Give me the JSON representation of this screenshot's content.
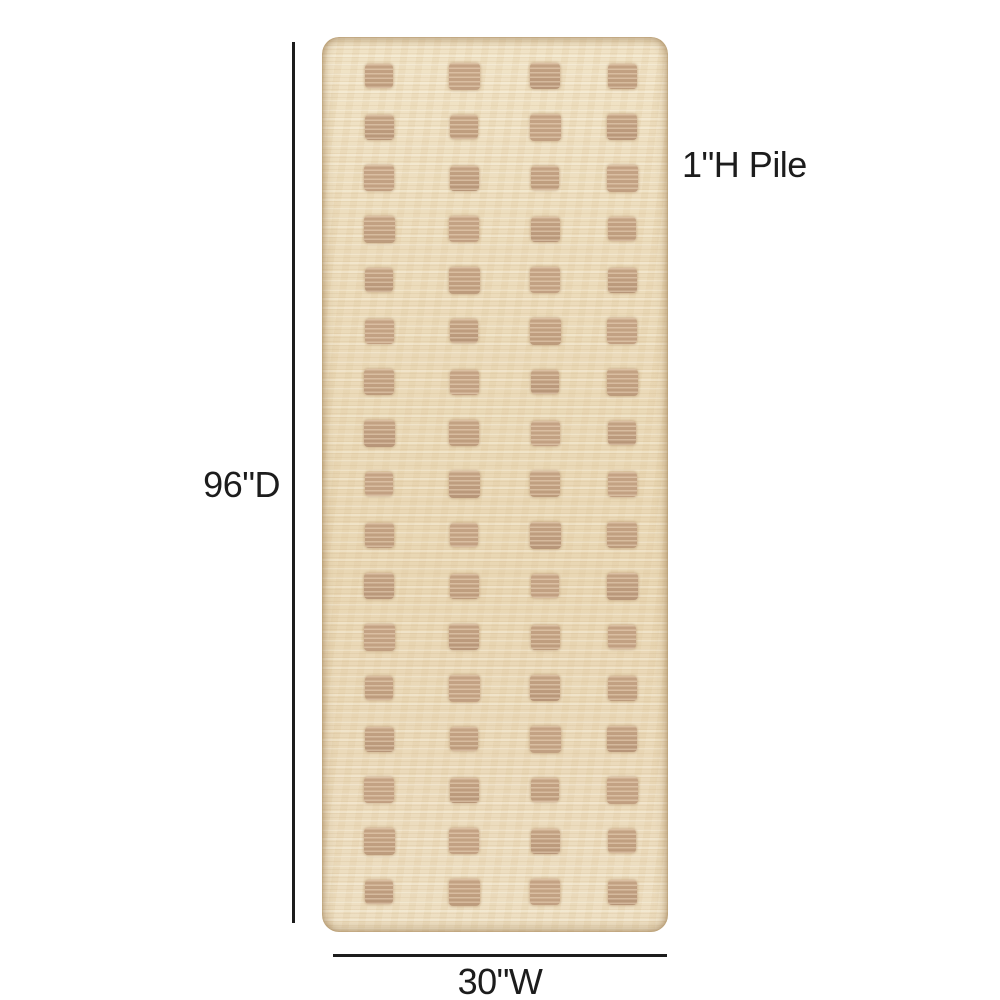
{
  "diagram": {
    "annotations": {
      "depth_label": "96\"D",
      "width_label": "30\"W",
      "pile_label": "1\"H Pile"
    },
    "pattern": {
      "rows": 17,
      "columns": 4
    },
    "colors": {
      "background": "#ffffff",
      "rug_base": "#ebdbbc",
      "rug_square": "#bd9c7d",
      "annotation_ink": "#1c1c1c"
    }
  }
}
